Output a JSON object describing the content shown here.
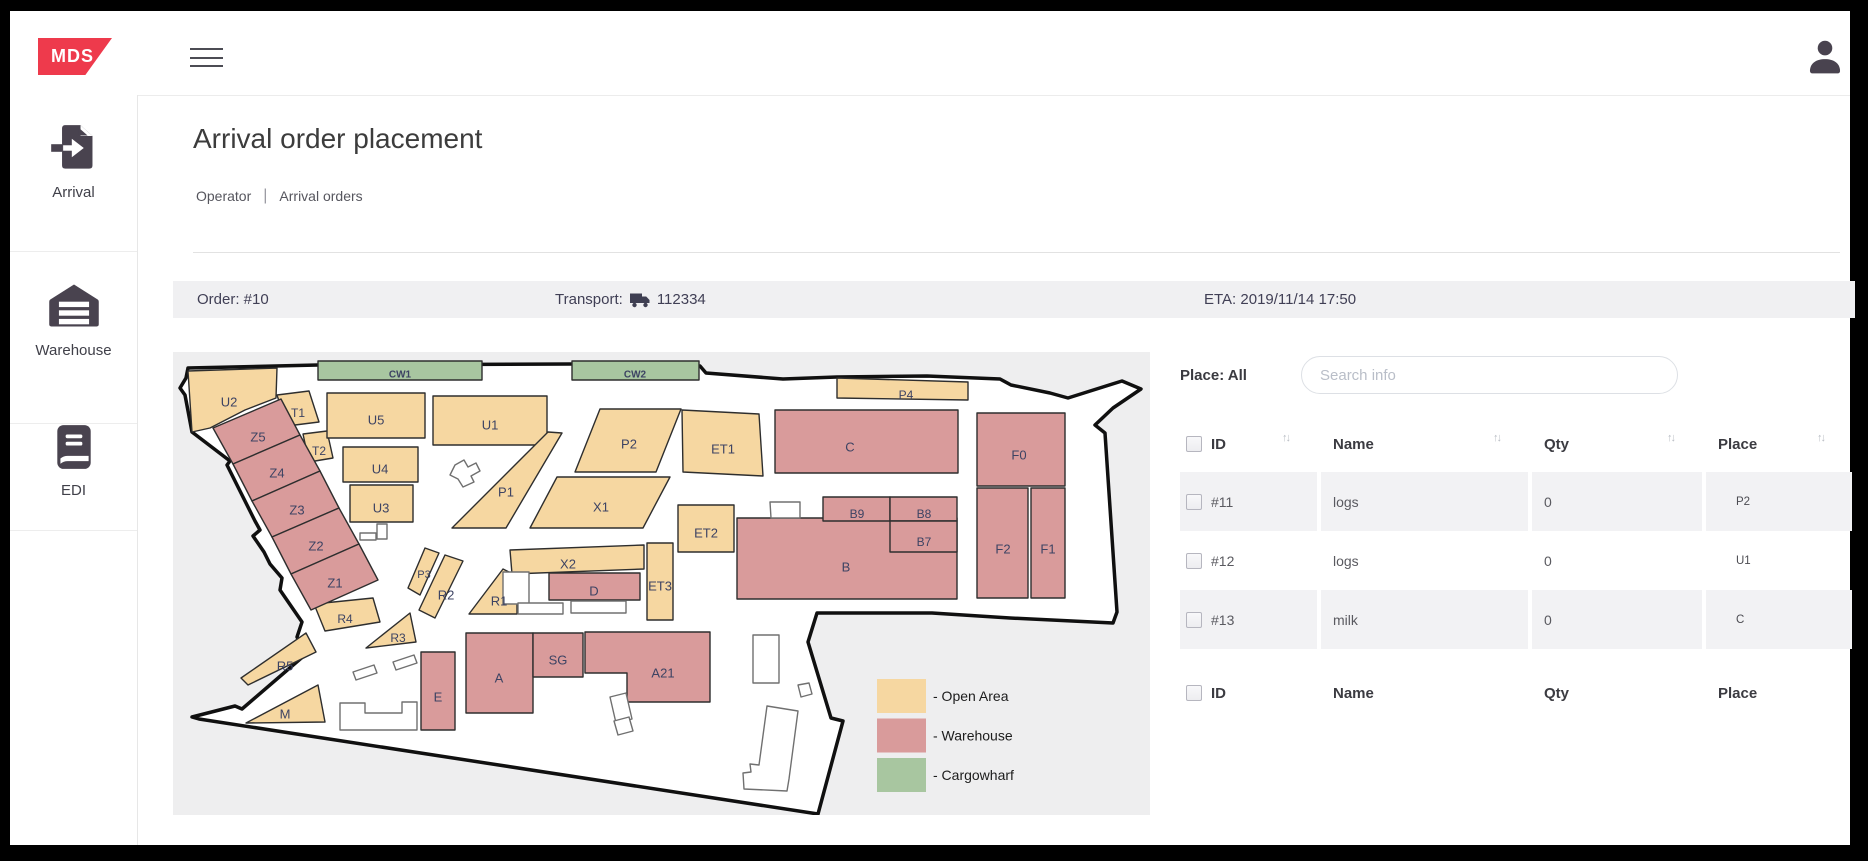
{
  "topbar": {
    "logo_text": "MDS",
    "logo_color": "#ee3a4c"
  },
  "sidebar": {
    "items": [
      {
        "id": "arrival",
        "label": "Arrival",
        "icon": "arrival-document-icon"
      },
      {
        "id": "warehouse",
        "label": "Warehouse",
        "icon": "warehouse-icon"
      },
      {
        "id": "edi",
        "label": "EDI",
        "icon": "edi-book-icon"
      }
    ]
  },
  "page": {
    "title": "Arrival order placement",
    "breadcrumb": {
      "section": "Operator",
      "current": "Arrival orders"
    }
  },
  "order_bar": {
    "order_label": "Order: #10",
    "transport_label": "Transport:",
    "transport_number": "112334",
    "eta_label": "ETA: 2019/11/14 17:50"
  },
  "map": {
    "colors": {
      "open": "#f6d7a1",
      "warehouse": "#d99b9b",
      "cargowharf": "#a8c6a0",
      "background": "#eeeeef",
      "boundary_fill": "#ffffff",
      "boundary_stroke": "#101010",
      "zone_stroke": "#2e2e2e",
      "outline_stroke": "#707070",
      "label_color": "#3d4363"
    },
    "boundary": "15,16 145,13 398,12 527,14 533,21 610,27 664,25 754,24 827,27 838,33 877,41 895,46 949,29 968,37 940,56 922,73 932,81 944,260 940,271 837,266 759,261 644,261 635,290 658,366 670,369 645,462 26,367 19,365 62,354 69,357 133,302 124,285 129,270 107,238 109,226 97,212 91,200 80,184 87,178 82,169 54,113 57,109 19,80 12,43 7,36 13,26",
    "zones": [
      {
        "label": "CW1",
        "type": "cargowharf",
        "points": "145,9 309,9 309,28 145,28",
        "lx": 227,
        "ly": 22,
        "fs": 10
      },
      {
        "label": "CW2",
        "type": "cargowharf",
        "points": "399,9 526,9 526,28 399,28",
        "lx": 462,
        "ly": 22,
        "fs": 10
      },
      {
        "label": "U2",
        "type": "open",
        "points": "15,19 104,16 103,46 72,58 37,76 19,80",
        "lx": 56,
        "ly": 50,
        "fs": 13
      },
      {
        "label": "T1",
        "type": "open",
        "points": "104,43 136,39 146,70 114,74",
        "lx": 125,
        "ly": 61,
        "fs": 12
      },
      {
        "label": "T2",
        "type": "open",
        "points": "130,82 154,79 160,106 136,110",
        "lx": 146,
        "ly": 99,
        "fs": 12
      },
      {
        "label": "U5",
        "type": "open",
        "points": "154,41 252,41 252,86 154,86",
        "lx": 203,
        "ly": 68,
        "fs": 13
      },
      {
        "label": "U4",
        "type": "open",
        "points": "170,95 245,95 245,130 170,130",
        "lx": 207,
        "ly": 117,
        "fs": 13
      },
      {
        "label": "U3",
        "type": "open",
        "points": "177,133 240,133 240,170 177,170",
        "lx": 208,
        "ly": 156,
        "fs": 13
      },
      {
        "label": "U1",
        "type": "open",
        "points": "260,44 374,44 374,93 260,93",
        "lx": 317,
        "ly": 73,
        "fs": 13
      },
      {
        "label": "P1",
        "type": "open",
        "points": "279,176 333,176 389,81 375,80",
        "lx": 333,
        "ly": 140,
        "fs": 13
      },
      {
        "label": "P2",
        "type": "open",
        "points": "427,57 508,57 483,120 402,120",
        "lx": 456,
        "ly": 92,
        "fs": 13
      },
      {
        "label": "X1",
        "type": "open",
        "points": "384,125 497,125 470,176 357,176",
        "lx": 428,
        "ly": 155,
        "fs": 13
      },
      {
        "label": "X2",
        "type": "open",
        "points": "337,198 471,193 471,217 339,222",
        "lx": 395,
        "ly": 212,
        "fs": 13
      },
      {
        "label": "P3",
        "type": "open",
        "points": "252,196 266,201 247,243 235,236",
        "lx": 251,
        "ly": 222,
        "fs": 11
      },
      {
        "label": "R2",
        "type": "open",
        "points": "272,203 290,209 262,266 246,258",
        "lx": 273,
        "ly": 243,
        "fs": 13
      },
      {
        "label": "R1",
        "type": "open",
        "points": "296,262 330,217 344,224 344,262",
        "lx": 326,
        "ly": 249,
        "fs": 13
      },
      {
        "label": "R4",
        "type": "open",
        "points": "141,252 200,246 207,270 152,279",
        "lx": 172,
        "ly": 267,
        "fs": 12
      },
      {
        "label": "R3",
        "type": "open",
        "points": "237,261 243,290 193,296",
        "lx": 225,
        "ly": 286,
        "fs": 12
      },
      {
        "label": "R5",
        "type": "open",
        "points": "133,281 143,300 75,333 68,326",
        "lx": 112,
        "ly": 314,
        "fs": 13
      },
      {
        "label": "M",
        "type": "open",
        "points": "145,333 152,370 73,371",
        "lx": 112,
        "ly": 362,
        "fs": 13
      },
      {
        "label": "ET1",
        "type": "open",
        "points": "509,58 586,62 590,124 510,120",
        "lx": 550,
        "ly": 97,
        "fs": 13
      },
      {
        "label": "ET2",
        "type": "open",
        "points": "505,153 561,153 561,200 505,200",
        "lx": 533,
        "ly": 181,
        "fs": 13
      },
      {
        "label": "ET3",
        "type": "open",
        "points": "474,191 500,191 500,268 474,268",
        "lx": 487,
        "ly": 234,
        "fs": 13
      },
      {
        "label": "P4",
        "type": "open",
        "points": "664,26 795,30 795,48 664,46",
        "lx": 733,
        "ly": 43,
        "fs": 12
      },
      {
        "label": "Z5",
        "type": "warehouse",
        "points": "40,76 108,47 127,83 60,112",
        "lx": 85,
        "ly": 85,
        "fs": 13
      },
      {
        "label": "Z4",
        "type": "warehouse",
        "points": "60,112 127,83 147,119 79,149",
        "lx": 104,
        "ly": 121,
        "fs": 13
      },
      {
        "label": "Z3",
        "type": "warehouse",
        "points": "79,149 147,119 166,156 99,185",
        "lx": 124,
        "ly": 158,
        "fs": 13
      },
      {
        "label": "Z2",
        "type": "warehouse",
        "points": "99,185 166,156 186,192 118,222",
        "lx": 143,
        "ly": 194,
        "fs": 13
      },
      {
        "label": "Z1",
        "type": "warehouse",
        "points": "118,222 186,192 205,228 138,258",
        "lx": 162,
        "ly": 231,
        "fs": 13
      },
      {
        "label": "D",
        "type": "warehouse",
        "points": "376,221 467,221 467,248 376,248",
        "lx": 421,
        "ly": 239,
        "fs": 13
      },
      {
        "label": "E",
        "type": "warehouse",
        "points": "248,300 282,300 282,378 248,378",
        "lx": 265,
        "ly": 345,
        "fs": 13
      },
      {
        "label": "A",
        "type": "warehouse",
        "points": "293,281 360,281 360,361 293,361",
        "lx": 326,
        "ly": 326,
        "fs": 13
      },
      {
        "label": "SG",
        "type": "warehouse",
        "points": "360,281 410,281 410,325 360,325",
        "lx": 385,
        "ly": 308,
        "fs": 13
      },
      {
        "label": "A21",
        "type": "warehouse",
        "points": "412,280 537,280 537,350 454,350 454,321 412,321",
        "lx": 490,
        "ly": 321,
        "fs": 13
      },
      {
        "label": "B",
        "type": "warehouse",
        "points": "564,166 784,166 784,247 564,247",
        "lx": 673,
        "ly": 215,
        "fs": 13
      },
      {
        "label": "B9",
        "type": "warehouse",
        "points": "650,145 717,145 717,169 650,169",
        "lx": 684,
        "ly": 162,
        "fs": 12
      },
      {
        "label": "B8",
        "type": "warehouse",
        "points": "717,145 784,145 784,169 717,169",
        "lx": 751,
        "ly": 162,
        "fs": 12
      },
      {
        "label": "B7",
        "type": "warehouse",
        "points": "717,169 784,169 784,200 717,200",
        "lx": 751,
        "ly": 190,
        "fs": 12
      },
      {
        "label": "C",
        "type": "warehouse",
        "points": "602,58 785,58 785,121 602,121",
        "lx": 677,
        "ly": 95,
        "fs": 13
      },
      {
        "label": "F0",
        "type": "warehouse",
        "points": "804,61 892,61 892,134 804,134",
        "lx": 846,
        "ly": 103,
        "fs": 13
      },
      {
        "label": "F2",
        "type": "warehouse",
        "points": "804,136 855,136 855,246 804,246",
        "lx": 830,
        "ly": 197,
        "fs": 13
      },
      {
        "label": "F1",
        "type": "warehouse",
        "points": "858,136 892,136 892,246 858,246",
        "lx": 875,
        "ly": 197,
        "fs": 13
      }
    ],
    "outlines": [
      "204,172 214,172 214,187 204,187",
      "187,181 203,181 203,188 187,188",
      "282,113 291,108 295,115 303,111 307,119 298,124 301,130 290,135 285,127 277,123",
      "330,220 356,220 356,252 330,252",
      "345,251 390,251 390,262 345,262",
      "398,249 453,249 453,261 398,261",
      "597,150 627,150 627,166 598,166",
      "580,283 606,283 606,331 580,331",
      "625,333 636,331 639,342 628,345",
      "594,354 625,359 616,427 614,439 571,437 570,421 578,420 577,412 586,413",
      "167,351 192,351 192,361 229,361 229,350 244,350 244,378 167,378",
      "180,320 201,313 204,321 183,328",
      "220,310 241,303 244,311 223,318",
      "437,345 453,341 459,367 443,371",
      "441,369 456,365 460,379 445,383"
    ],
    "legend": [
      {
        "label": "- Open Area",
        "type": "open"
      },
      {
        "label": "- Warehouse",
        "type": "warehouse"
      },
      {
        "label": "- Cargowharf",
        "type": "cargowharf"
      }
    ]
  },
  "panel": {
    "place_filter_label": "Place: All",
    "search_placeholder": "Search info",
    "columns": [
      "ID",
      "Name",
      "Qty",
      "Place"
    ],
    "sort_glyph": "↑↓",
    "rows": [
      {
        "id": "#11",
        "name": "logs",
        "qty": "0",
        "place": "P2"
      },
      {
        "id": "#12",
        "name": "logs",
        "qty": "0",
        "place": "U1"
      },
      {
        "id": "#13",
        "name": "milk",
        "qty": "0",
        "place": "C"
      }
    ]
  }
}
